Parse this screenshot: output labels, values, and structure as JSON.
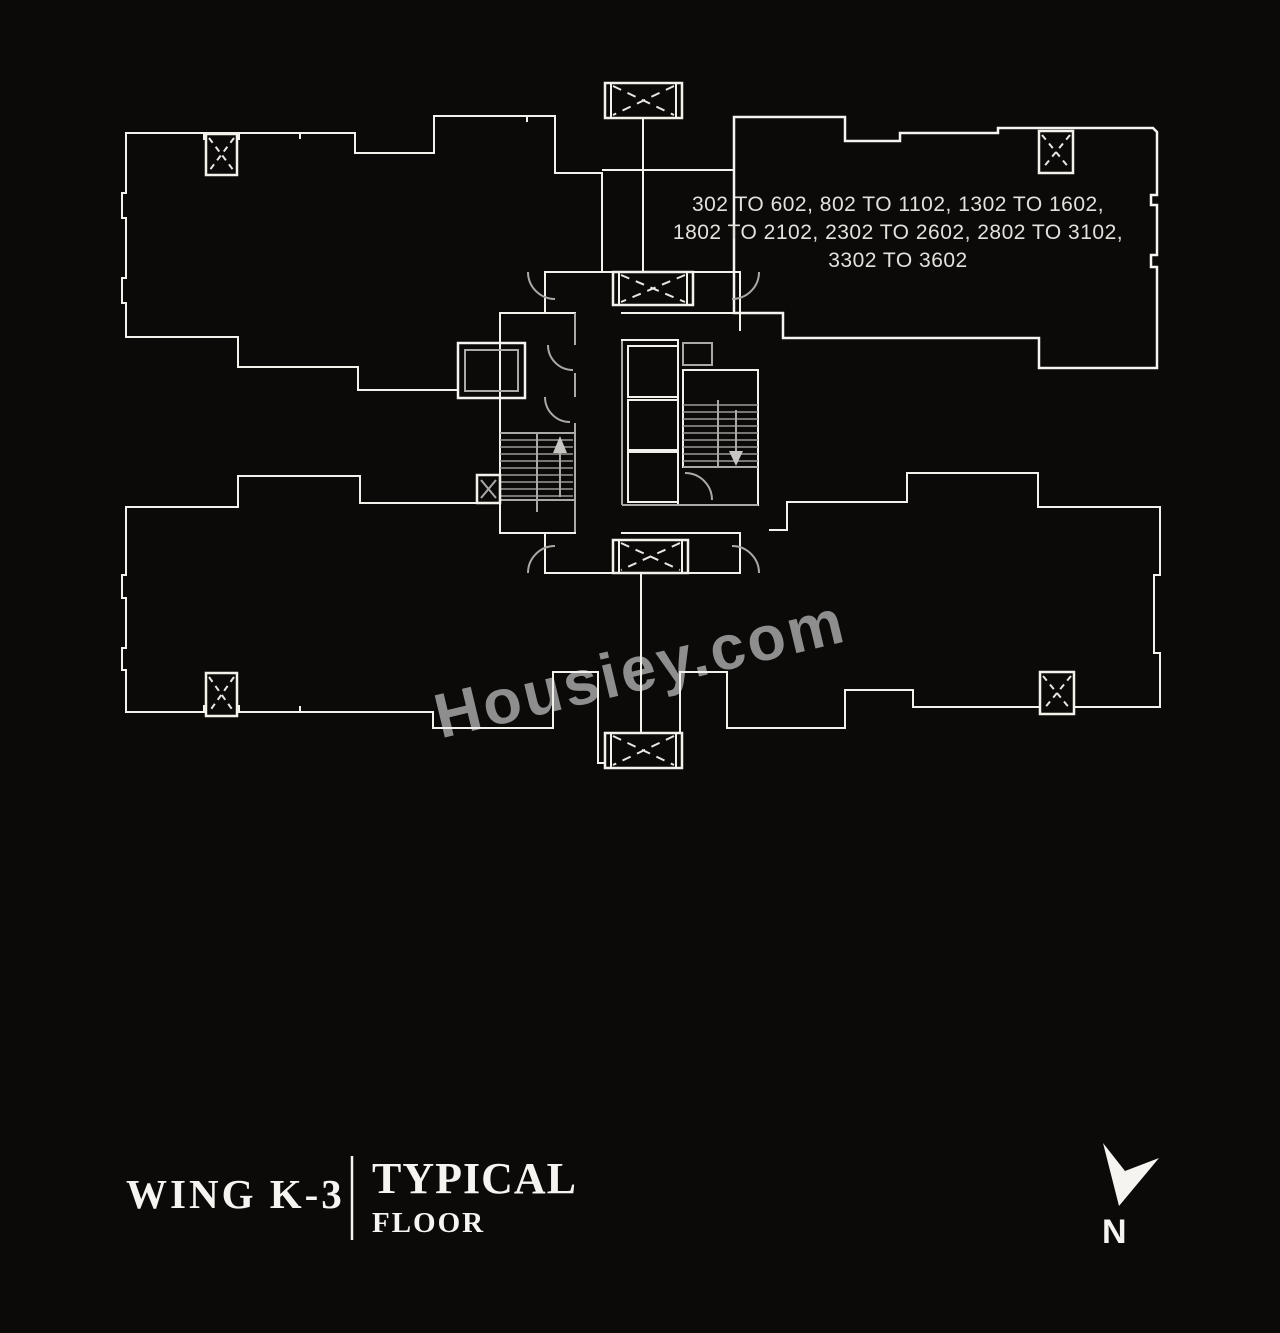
{
  "page": {
    "background_color": "#0c0a08",
    "line_color": "#f2f1ec"
  },
  "plan": {
    "highlighted_unit": {
      "label_lines": [
        "302 TO 602, 802 TO 1102, 1302 TO 1602,",
        "1802 TO 2102, 2302 TO 2602, 2802 TO 3102,",
        "3302 TO 3602"
      ],
      "fill_color": "#3e3e3e",
      "text_color": "#e2e1dc"
    },
    "icons": {
      "duct": "duct-x-icon",
      "shaft": "shaft-x-icon",
      "stair_up": "stair-up-arrow-icon",
      "stair_down": "stair-down-arrow-icon",
      "door": "door-swing-arc"
    }
  },
  "watermark": {
    "text": "Housiey.com",
    "color": "#8e8e8e"
  },
  "title_block": {
    "wing_label": "WING K-3",
    "floor_label": "TYPICAL",
    "floor_sublabel": "FLOOR"
  },
  "compass": {
    "north_label": "N"
  }
}
